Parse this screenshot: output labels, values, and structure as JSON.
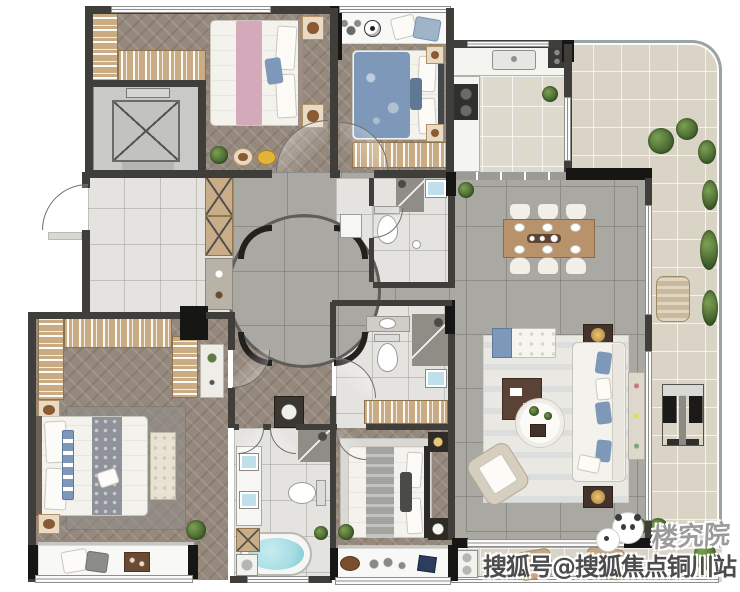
{
  "watermark": {
    "brand": "楼究院",
    "account": "搜狐号@搜狐焦点铜川站",
    "logo": "panda-icon"
  },
  "palette": {
    "wall": "#3f3e3b",
    "column": "#161614",
    "wood_floor": "#95887c",
    "marble_floor": "#aaa8a3",
    "light_tile": "#e4e3df",
    "beige_tile": "#d9d4c6",
    "kitchen_tile": "#ddd9cd",
    "bed_pink": "#d4a9b9",
    "bed_blue": "#7d98b8",
    "bath_water": "#a5dde4",
    "plant_green": "#5d7c42",
    "closet_wood": "#c9ab84",
    "dining_wood": "#b7926a"
  }
}
